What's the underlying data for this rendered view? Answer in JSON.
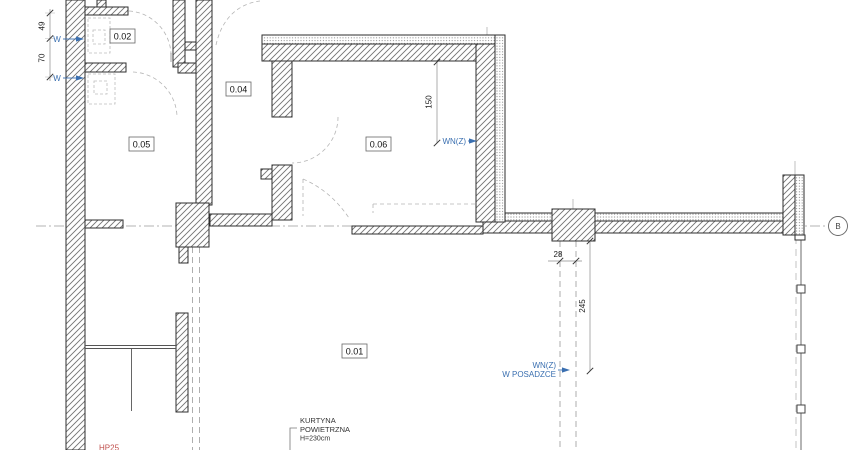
{
  "rooms": {
    "r001": "0.01",
    "r002": "0.02",
    "r004": "0.04",
    "r005": "0.05",
    "r006": "0.06"
  },
  "dimensions": {
    "d49": "49",
    "d70": "70",
    "d150": "150",
    "d28": "28",
    "d245": "245"
  },
  "annotations": {
    "w1": "W",
    "w2": "W",
    "wnz": "WN(Z)",
    "wnz_floor_line1": "WN(Z)",
    "wnz_floor_line2": "W POSADZCE",
    "grid_bubble": "B",
    "curtain_line1": "KURTYNA",
    "curtain_line2": "POWIETRZNA",
    "curtain_line3": "H=230cm",
    "hp": "HP25"
  },
  "colors": {
    "annotation_blue": "#3a6fb0",
    "hp_red": "#c0504d",
    "wall_line": "#2e2e2e",
    "dash_gray": "#b5b5b5"
  }
}
